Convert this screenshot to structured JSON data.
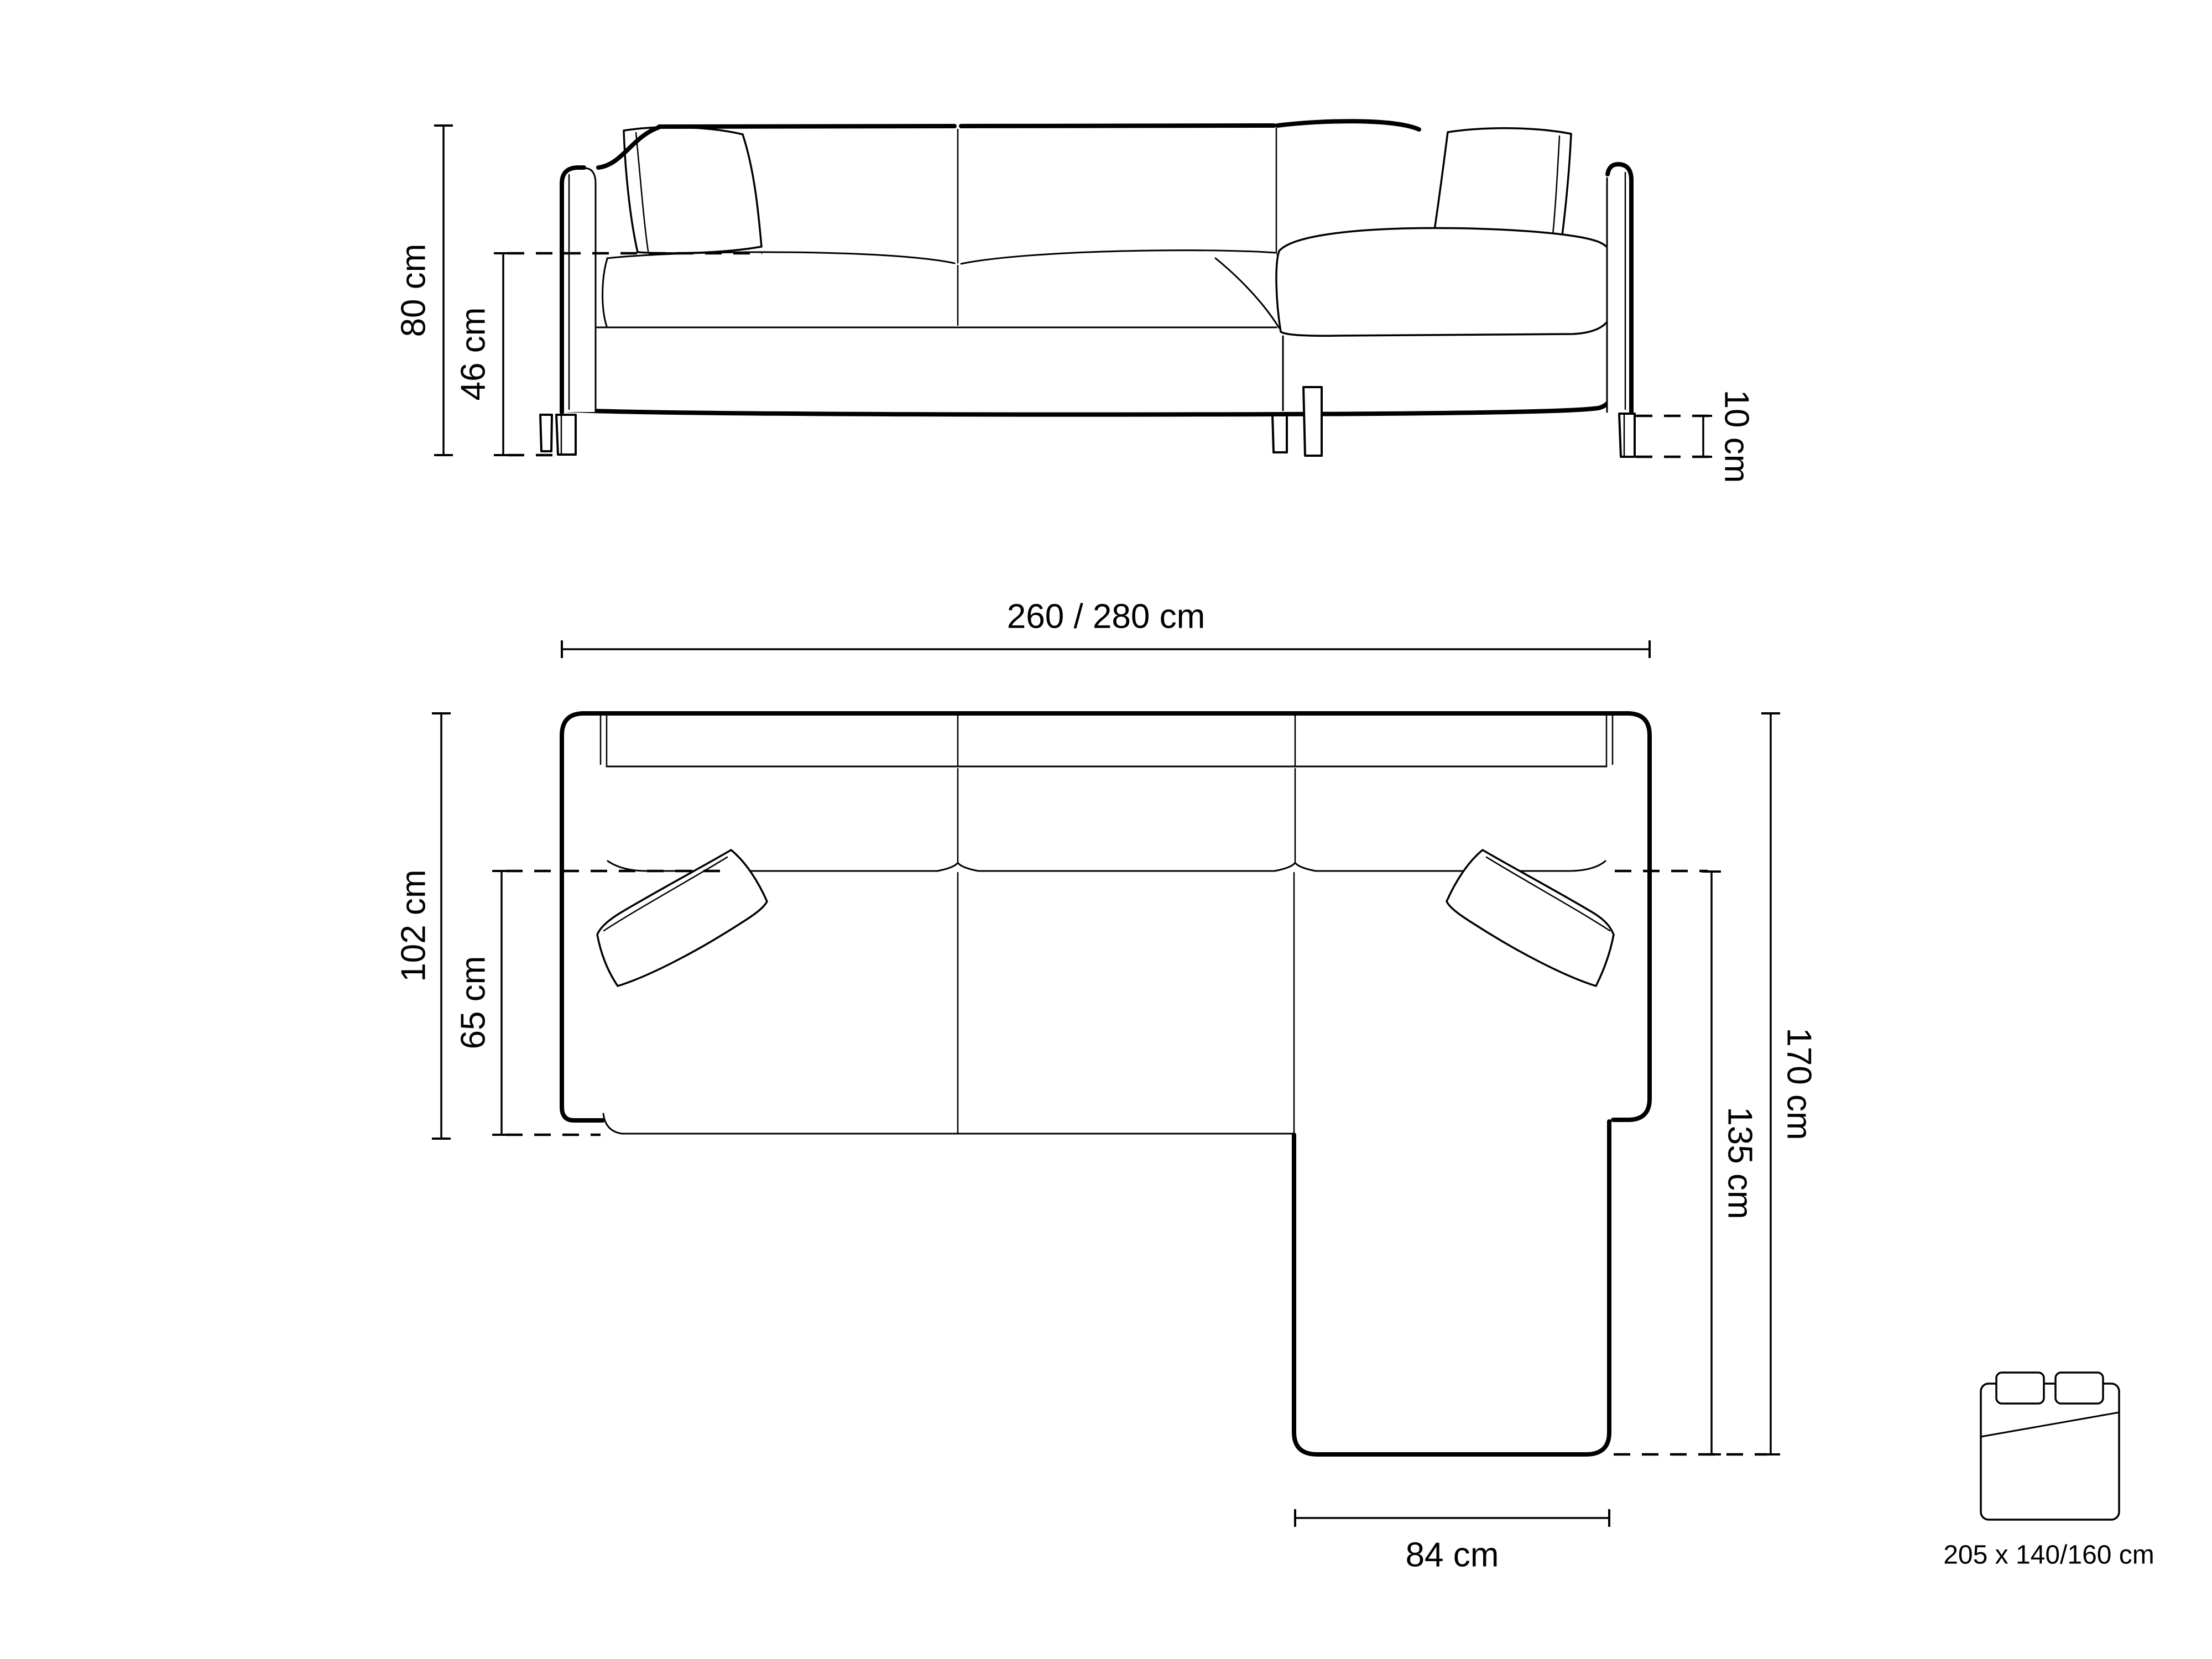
{
  "page": {
    "background_color": "#ffffff",
    "line_color": "#000000",
    "description": "Technical dimension drawing of a corner sofa with chaise, front elevation and top plan views, plus sleeping-surface bed icon"
  },
  "front_view": {
    "name": "front-elevation-view",
    "dimensions": {
      "total_height": {
        "label": "80 cm",
        "value": 80,
        "unit": "cm"
      },
      "seat_height": {
        "label": "46 cm",
        "value": 46,
        "unit": "cm"
      },
      "leg_height": {
        "label": "10 cm",
        "value": 10,
        "unit": "cm"
      }
    }
  },
  "top_view": {
    "name": "top-plan-view",
    "dimensions": {
      "total_width": {
        "label": "260 / 280 cm",
        "values": [
          260,
          280
        ],
        "unit": "cm"
      },
      "body_depth": {
        "label": "102 cm",
        "value": 102,
        "unit": "cm"
      },
      "seat_depth": {
        "label": "65 cm",
        "value": 65,
        "unit": "cm"
      },
      "total_depth": {
        "label": "170 cm",
        "value": 170,
        "unit": "cm"
      },
      "chaise_depth": {
        "label": "135 cm",
        "value": 135,
        "unit": "cm"
      },
      "chaise_width": {
        "label": "84 cm",
        "value": 84,
        "unit": "cm"
      }
    }
  },
  "sleeping_function": {
    "icon": "bed-icon",
    "size_label": "205 x 140/160 cm",
    "bed_length": 205,
    "bed_widths": [
      140,
      160
    ],
    "unit": "cm"
  }
}
